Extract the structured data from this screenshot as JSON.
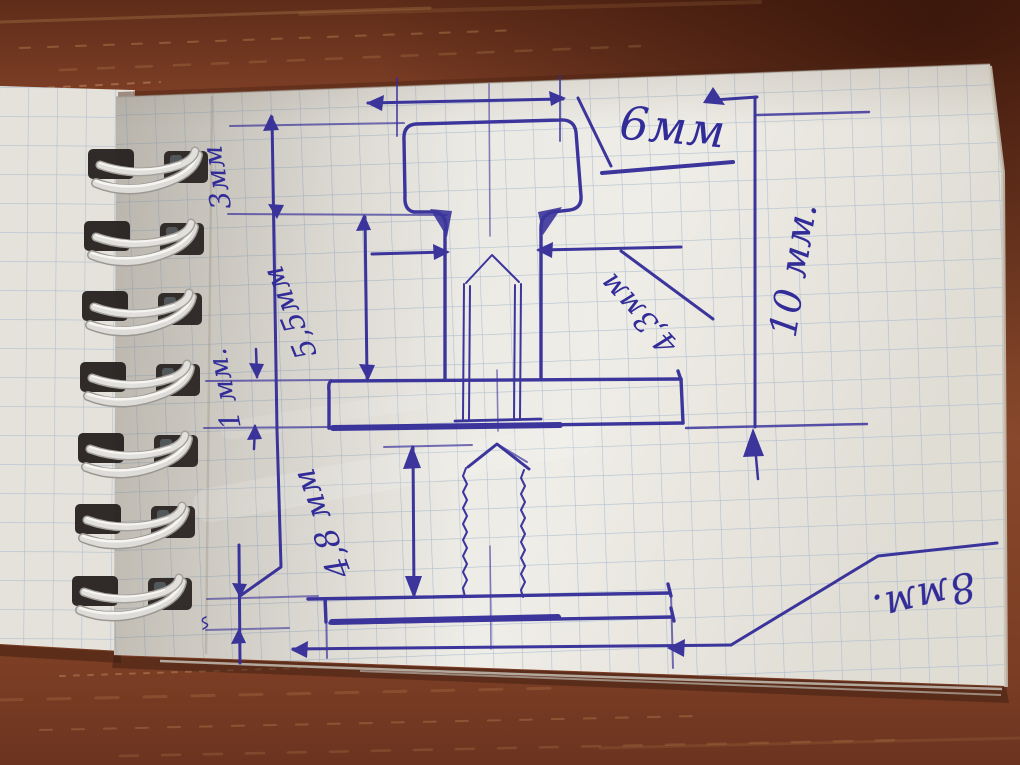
{
  "scene": {
    "description": "Photograph of a spiral-bound squared notepad on a wooden table with a hand-drawn pen sketch of a bolt (head, shank, flange) and a threaded stud with dimension lines",
    "notebook": {
      "paper": "squared",
      "binding": "spiral",
      "coil_count": 7
    },
    "colors": {
      "ink": "#322c98",
      "paper": "#eae8e2",
      "grid_line": "#9cb3cc",
      "wood": "#7d4026",
      "coil": "#dedcd8"
    }
  },
  "labels": {
    "head_width": "6мм",
    "overall_height": "10 мм.",
    "head_height": "3мм",
    "shank_length": "5,5мм",
    "flange_thickness": "1 мм.",
    "shank_diameter": "4,3мм",
    "stud_length": "4,8 мм",
    "base_plate_width": "8мм."
  }
}
